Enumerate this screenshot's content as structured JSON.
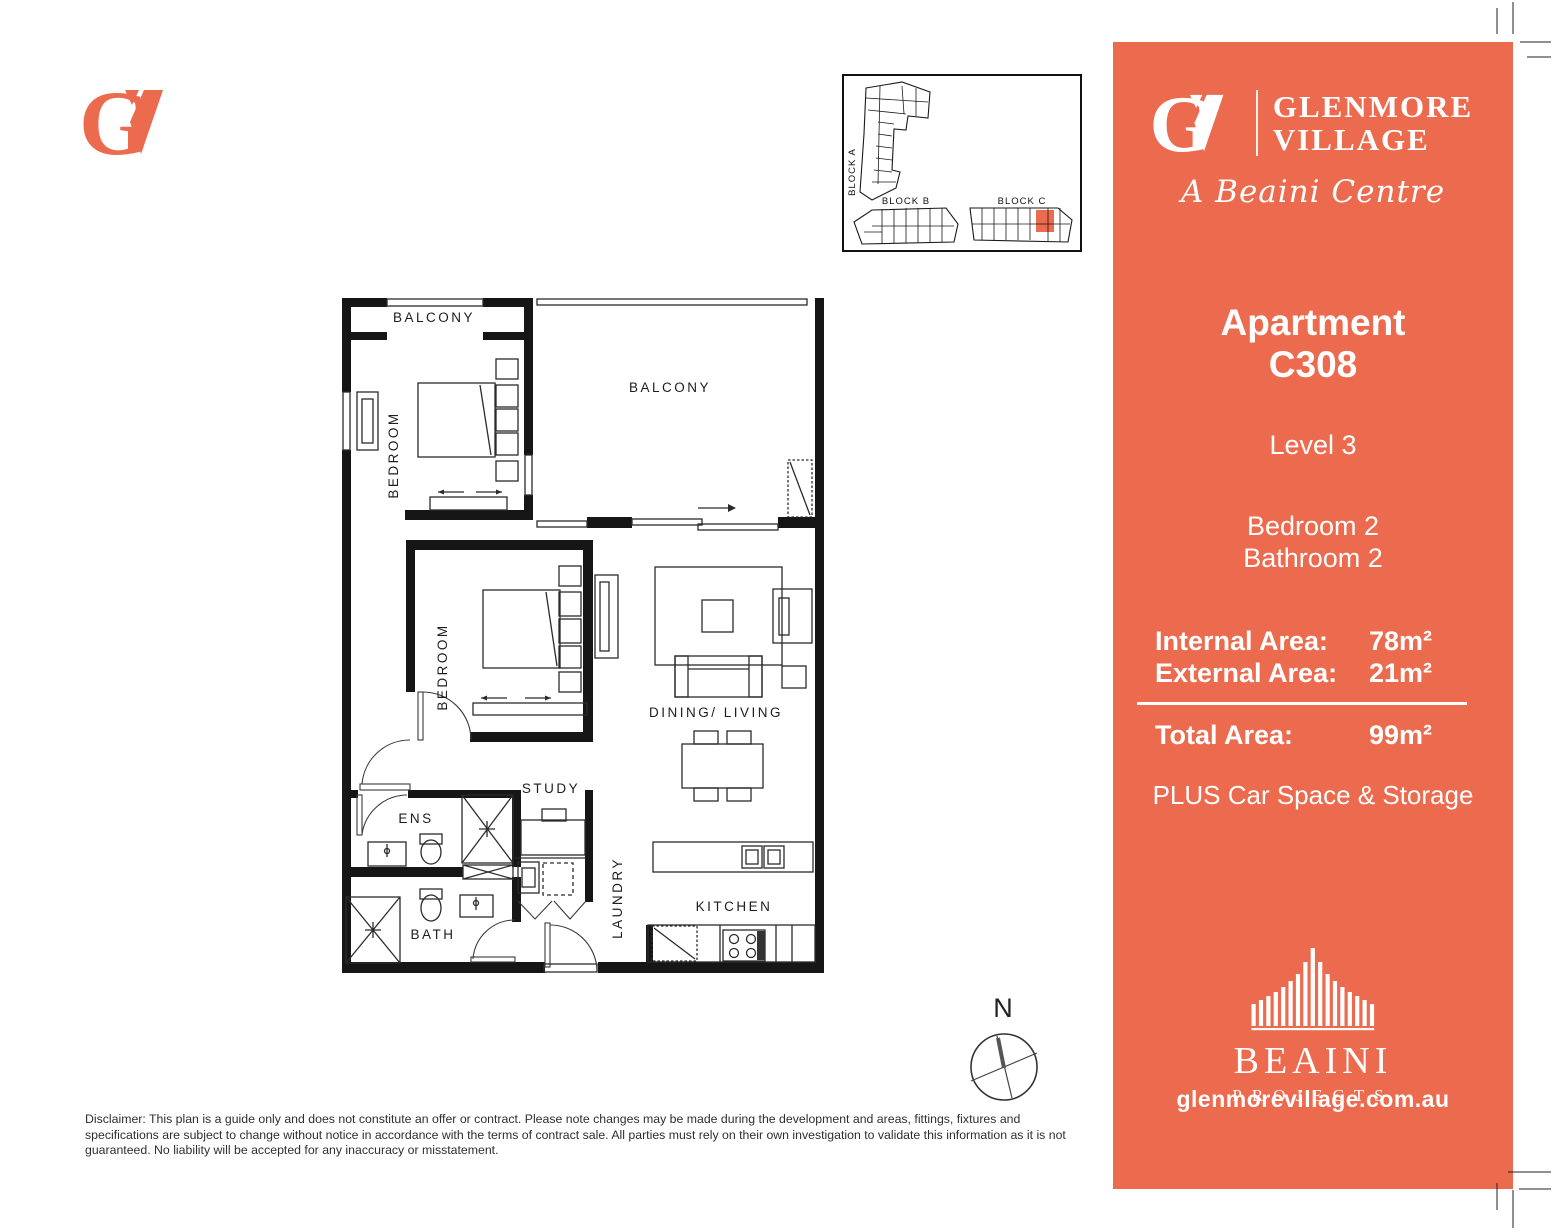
{
  "brand": {
    "color": "#EC6A4D",
    "g_letter": "G"
  },
  "site_plan": {
    "block_a_label": "BLOCK A",
    "block_b_label": "BLOCK B",
    "block_c_label": "BLOCK C",
    "highlight_color": "#EC6A4D"
  },
  "floor_plan": {
    "balcony_small": "BALCONY",
    "balcony_large": "BALCONY",
    "bedroom_1": "BEDROOM",
    "bedroom_2": "BEDROOM",
    "dining_living": "DINING/ LIVING",
    "study": "STUDY",
    "ens": "ENS",
    "laundry": "LAUNDRY",
    "bath": "BATH",
    "kitchen": "KITCHEN",
    "compass_n": "N"
  },
  "sidebar": {
    "brand_name_line1": "GLENMORE",
    "brand_name_line2": "VILLAGE",
    "tagline": "A Beaini Centre",
    "apartment_line1": "Apartment",
    "apartment_line2": "C308",
    "level": "Level 3",
    "bedrooms": "Bedroom 2",
    "bathrooms": "Bathroom 2",
    "internal_area_label": "Internal Area:",
    "internal_area_value": "78m²",
    "external_area_label": "External Area:",
    "external_area_value": "21m²",
    "total_area_label": "Total Area:",
    "total_area_value": "99m²",
    "plus_line": "PLUS Car Space & Storage",
    "developer_name": "BEAINI",
    "developer_sub": "PROJECTS",
    "website": "glenmorevillage.com.au"
  },
  "footer": {
    "disclaimer": "Disclaimer: This plan is a guide only and does not constitute an offer or contract. Please note changes may be made during the development and areas, fittings, fixtures and specifications are subject to change without notice in accordance with the terms of contract sale. All parties must rely on their own investigation to validate this information as it is not guaranteed. No liability will be accepted for any inaccuracy or misstatement."
  }
}
